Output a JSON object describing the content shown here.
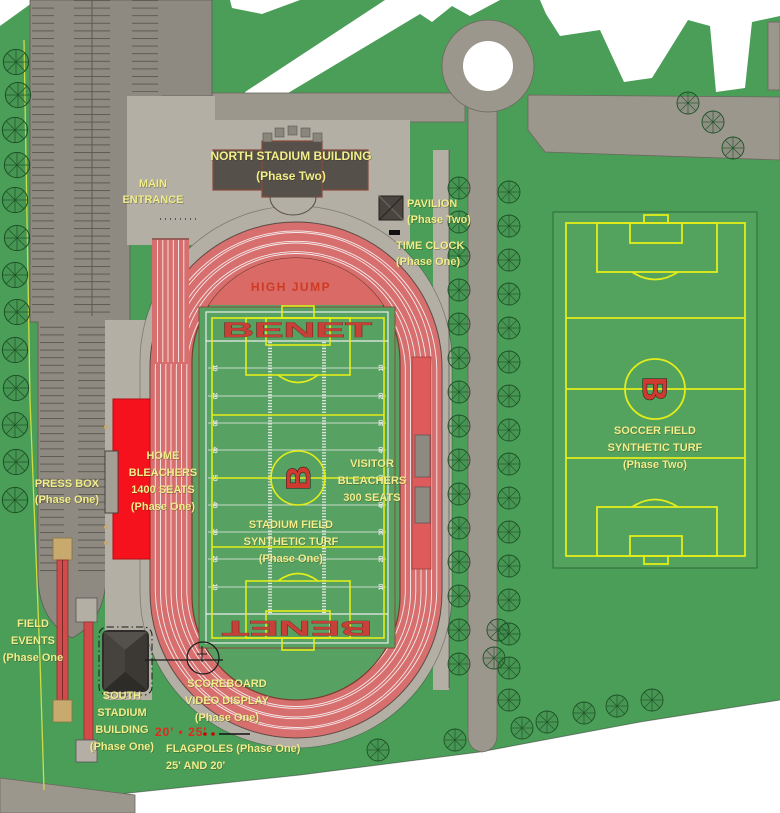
{
  "title": "Stadium athletic complex site plan",
  "labels": {
    "main_entrance": {
      "line1": "MAIN",
      "line2": "ENTRANCE"
    },
    "north_stadium": {
      "line1": "NORTH STADIUM BUILDING",
      "line2": "(Phase Two)"
    },
    "pavilion": {
      "line1": "PAVILION",
      "line2": "(Phase Two)"
    },
    "time_clock": {
      "line1": "TIME CLOCK",
      "line2": "(Phase One)"
    },
    "high_jump": "HIGH JUMP",
    "press_box": {
      "line1": "PRESS BOX",
      "line2": "(Phase One)"
    },
    "home_bleachers": {
      "line1": "HOME",
      "line2": "BLEACHERS",
      "line3": "1400 SEATS",
      "line4": "(Phase One)"
    },
    "visitor_bleachers": {
      "line1": "VISITOR",
      "line2": "BLEACHERS",
      "line3": "300 SEATS"
    },
    "stadium_field": {
      "line1": "STADIUM FIELD",
      "line2": "SYNTHETIC TURF",
      "line3": "(Phase One)"
    },
    "soccer_field": {
      "line1": "SOCCER FIELD",
      "line2": "SYNTHETIC TURF",
      "line3": "(Phase Two)"
    },
    "field_events": {
      "line1": "FIELD",
      "line2": "EVENTS",
      "line3": "(Phase One"
    },
    "south_stadium": {
      "line1": "SOUTH",
      "line2": "STADIUM",
      "line3": "BUILDING",
      "line4": "(Phase One)"
    },
    "scoreboard": {
      "line1": "SCOREBOARD",
      "line2": "VIDEO DISPLAY",
      "line3": "(Phase One)"
    },
    "flagpole_heights": "20'  •  25'",
    "flagpoles": {
      "line1": "FLAGPOLES (Phase One)",
      "line2": "25' AND 20'"
    }
  },
  "field": {
    "team_name": "BENET",
    "logo_letter": "B",
    "yard_numbers": [
      "10",
      "20",
      "30",
      "40",
      "50",
      "40",
      "30",
      "20",
      "10"
    ]
  },
  "colors": {
    "grass_green": "#4b9e58",
    "turf_green": "#57a263",
    "track_red": "#d76f6e",
    "bleacher_red": "#f5121c",
    "label_yellow": "#f2ee8a",
    "line_yellow": "#e3ed1a",
    "road_gray": "#9b978d",
    "plaza_gray": "#b3afa4",
    "building_brown": "#56504a"
  }
}
